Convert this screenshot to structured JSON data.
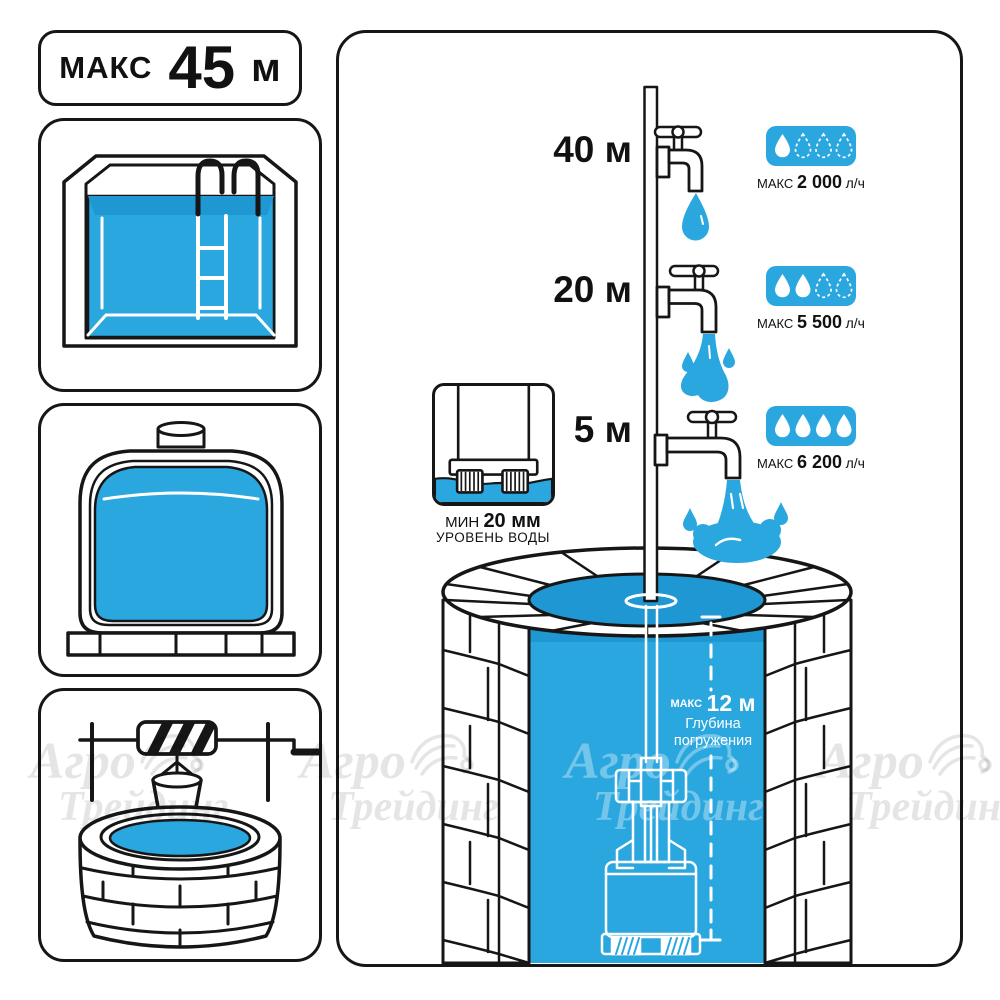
{
  "title_card": {
    "label": "МАКС",
    "number": "45",
    "unit": "м"
  },
  "taps": [
    {
      "height": "40 м",
      "flow_prefix": "МАКС",
      "flow_value": "2 000",
      "flow_unit": "л/ч",
      "drops_filled": 1,
      "drops_total": 4
    },
    {
      "height": "20 м",
      "flow_prefix": "МАКС",
      "flow_value": "5 500",
      "flow_unit": "л/ч",
      "drops_filled": 2,
      "drops_total": 4
    },
    {
      "height": "5 м",
      "flow_prefix": "МАКС",
      "flow_value": "6 200",
      "flow_unit": "л/ч",
      "drops_filled": 4,
      "drops_total": 4
    }
  ],
  "min_water_level": {
    "prefix": "МИН",
    "value": "20 мм",
    "caption": "УРОВЕНЬ ВОДЫ"
  },
  "immersion_depth": {
    "prefix": "МАКС",
    "value": "12 м",
    "caption_line1": "Глубина",
    "caption_line2": "погружения"
  },
  "watermark": {
    "line1": "Агро",
    "line2": "Трейдинг"
  },
  "icons": {
    "flow_badge": "water-droplets",
    "watermark_logo": "flower-swirl",
    "scene": "faucet-pipe-well-pump"
  },
  "colors": {
    "water": "#2BA7E0",
    "water_dark": "#1F97D3",
    "outline": "#161616",
    "badge": "#2BA7E0",
    "watermark_on_white": "rgba(0,0,0,0.10)",
    "watermark_on_water": "rgba(255,255,255,0.34)"
  }
}
